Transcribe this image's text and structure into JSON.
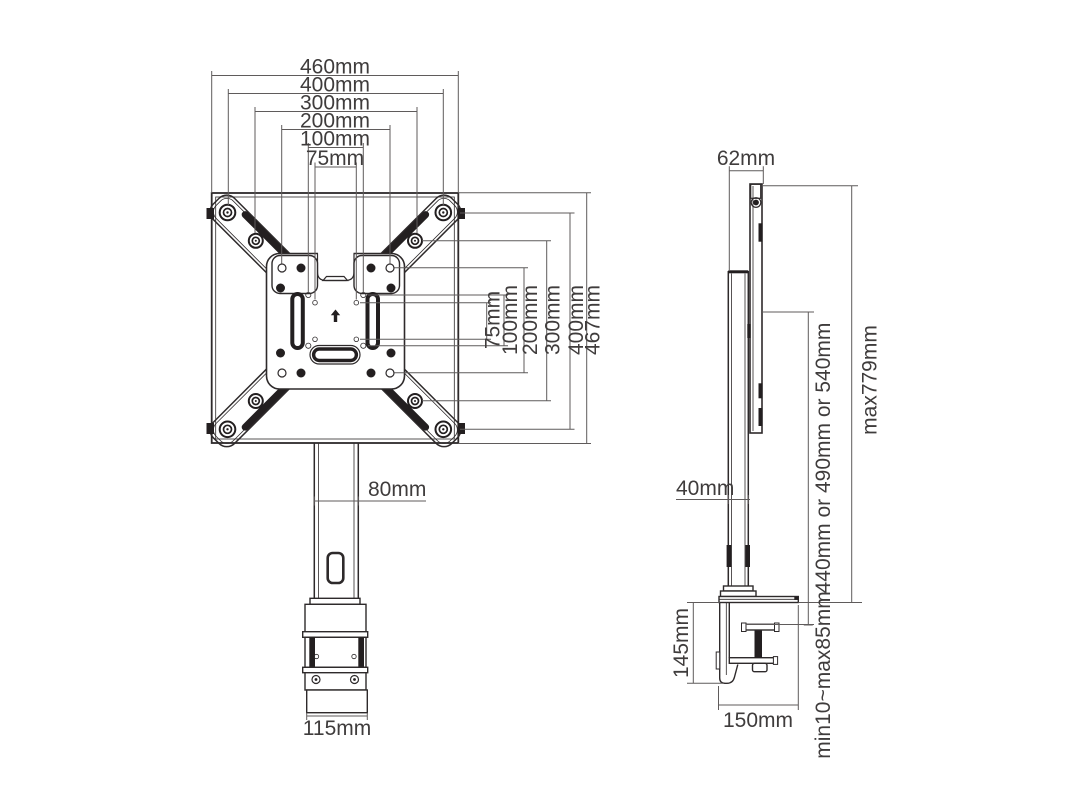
{
  "title": "desk-mount-dimension-drawing",
  "colors": {
    "background": "#ffffff",
    "part": "#2e2a2b",
    "dark": "#231f20",
    "dim": "#5f5b5b",
    "text": "#3f3c3c"
  },
  "front_view": {
    "width_dims": [
      "460mm",
      "400mm",
      "300mm",
      "200mm",
      "100mm",
      "75mm"
    ],
    "height_dims": [
      "75mm",
      "100mm",
      "200mm",
      "300mm",
      "400mm",
      "467mm"
    ],
    "pole_width": "80mm",
    "base_width": "115mm"
  },
  "side_view": {
    "top_offset": "62mm",
    "pole_depth": "40mm",
    "pole_height_options": "440mm or 490mm or 540mm",
    "max_total_height": "max779mm",
    "clamp_height": "145mm",
    "clamp_base_depth": "150mm",
    "desk_thickness_range": "min10~max85mm"
  }
}
